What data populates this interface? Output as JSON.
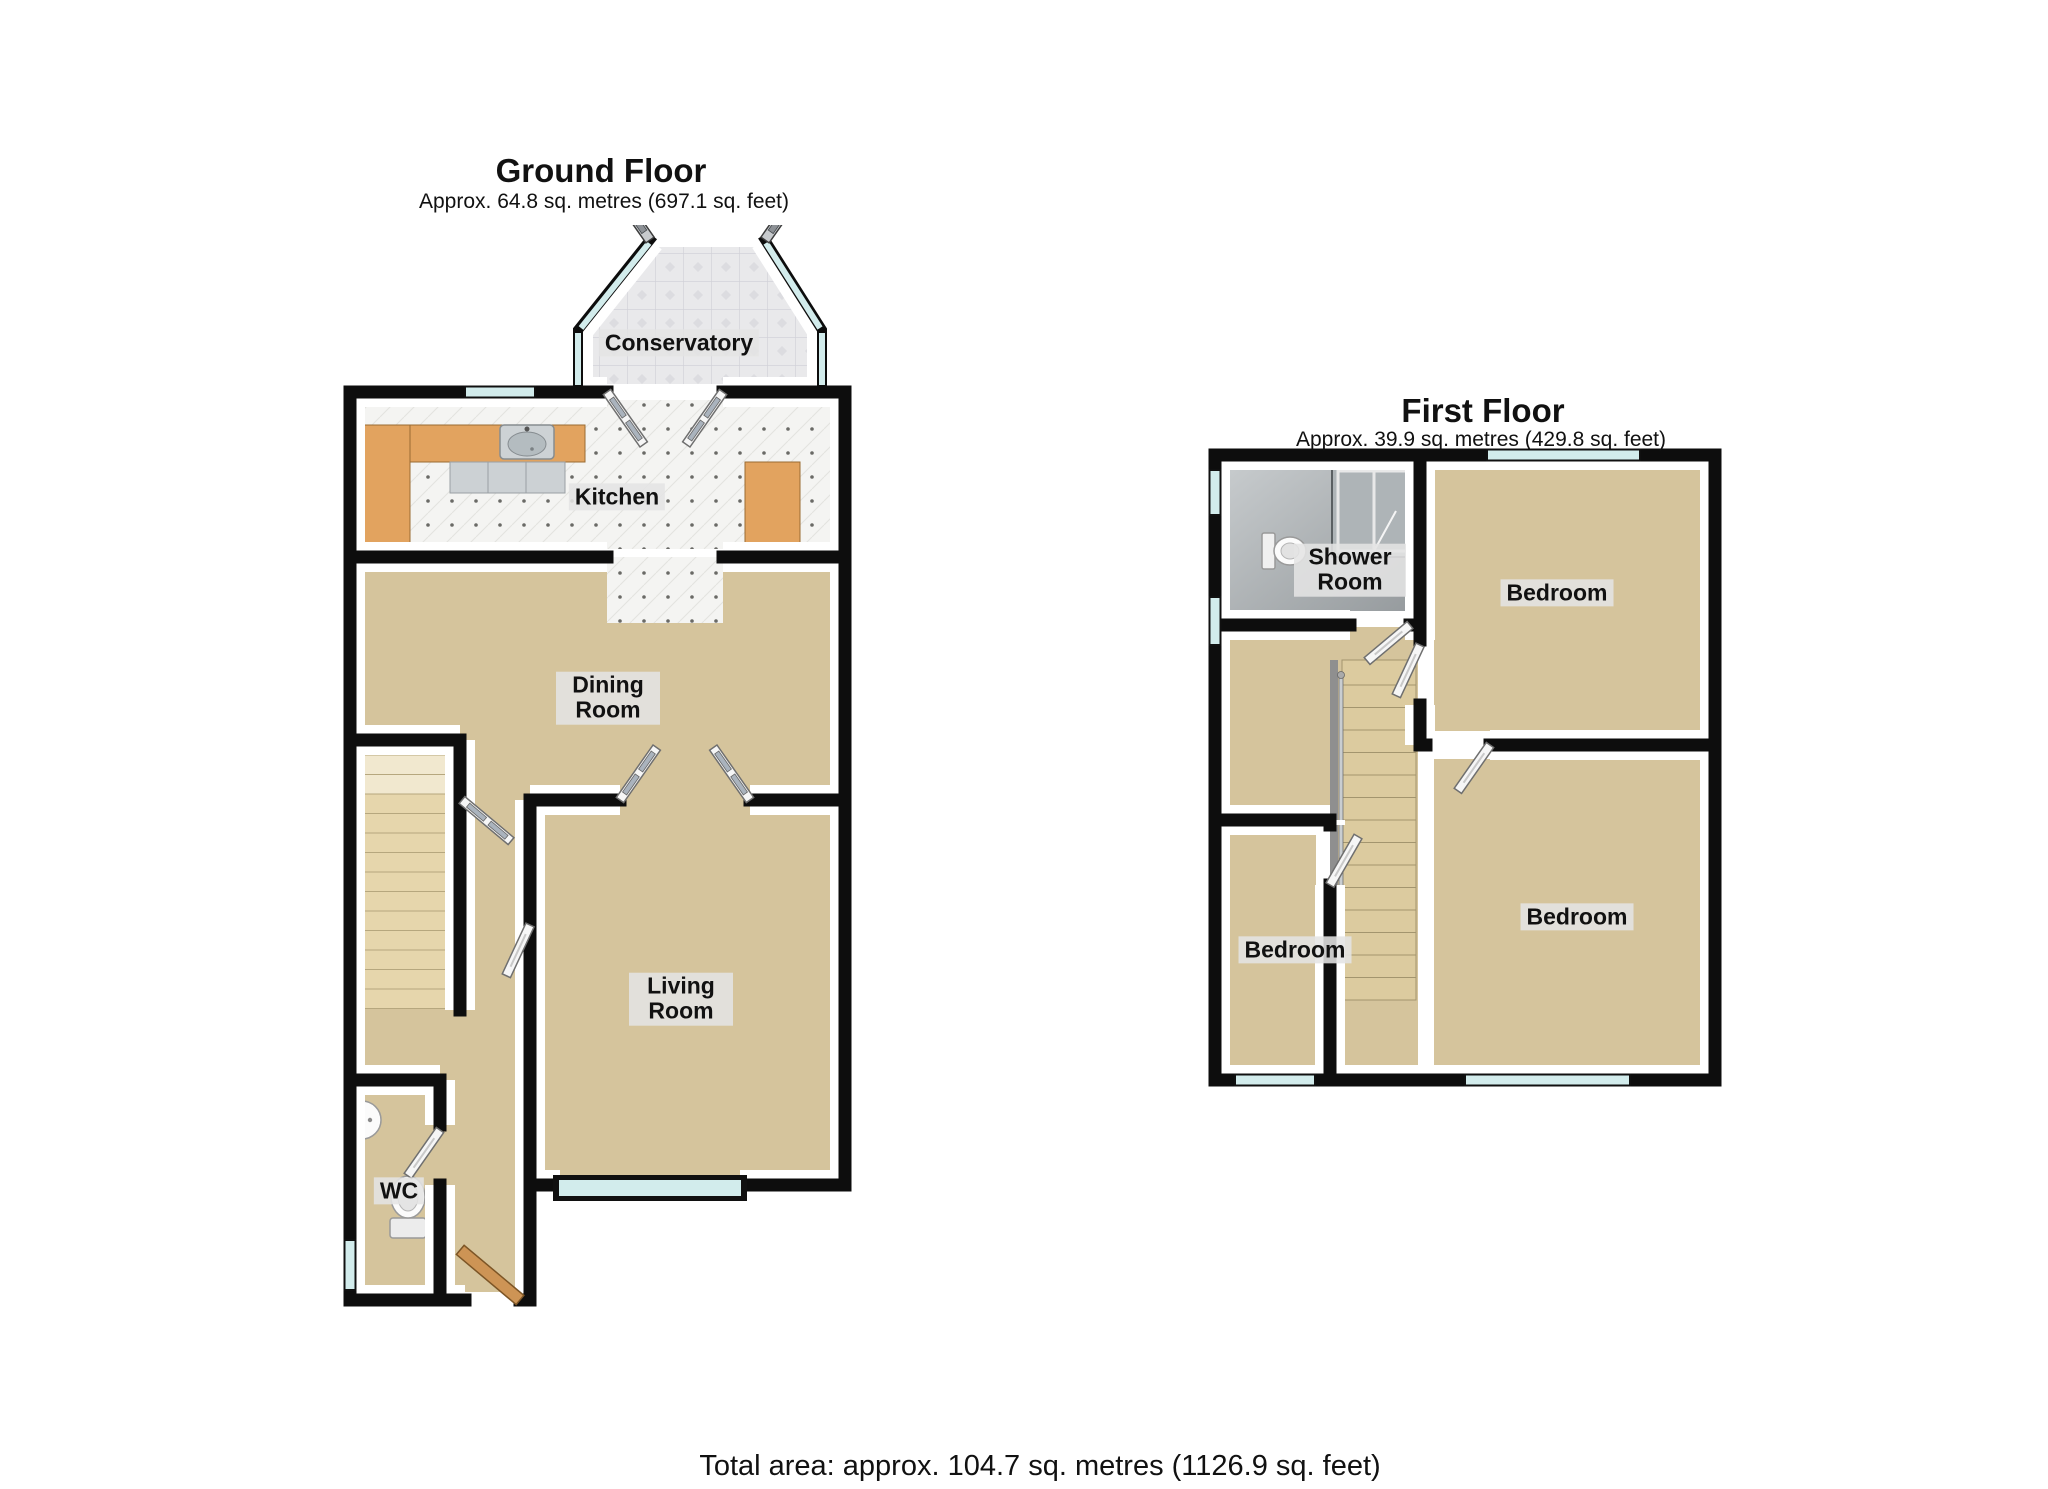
{
  "ground_floor": {
    "title": "Ground Floor",
    "subtitle": "Approx. 64.8 sq. metres (697.1 sq. feet)",
    "rooms": [
      {
        "name": "Conservatory"
      },
      {
        "name": "Kitchen"
      },
      {
        "name": "Dining Room"
      },
      {
        "name": "Living Room"
      },
      {
        "name": "WC"
      }
    ]
  },
  "first_floor": {
    "title": "First Floor",
    "subtitle": "Approx. 39.9 sq. metres (429.8 sq. feet)",
    "rooms": [
      {
        "name": "Shower Room"
      },
      {
        "name": "Bedroom"
      },
      {
        "name": "Bedroom"
      },
      {
        "name": "Bedroom"
      }
    ]
  },
  "footer": {
    "total": "Total area: approx. 104.7 sq. metres (1126.9 sq. feet)"
  },
  "colors": {
    "wall_color": "#0d0d0d",
    "carpet_color": "#d5c49c",
    "tile_color": "#f4f4f2",
    "glass_color": "#d2ecec",
    "counter_color": "#e2a35f",
    "door_color": "#f6f6f6",
    "wood_color": "#cd9455",
    "shower_floor_color": "#a9aeb1"
  }
}
